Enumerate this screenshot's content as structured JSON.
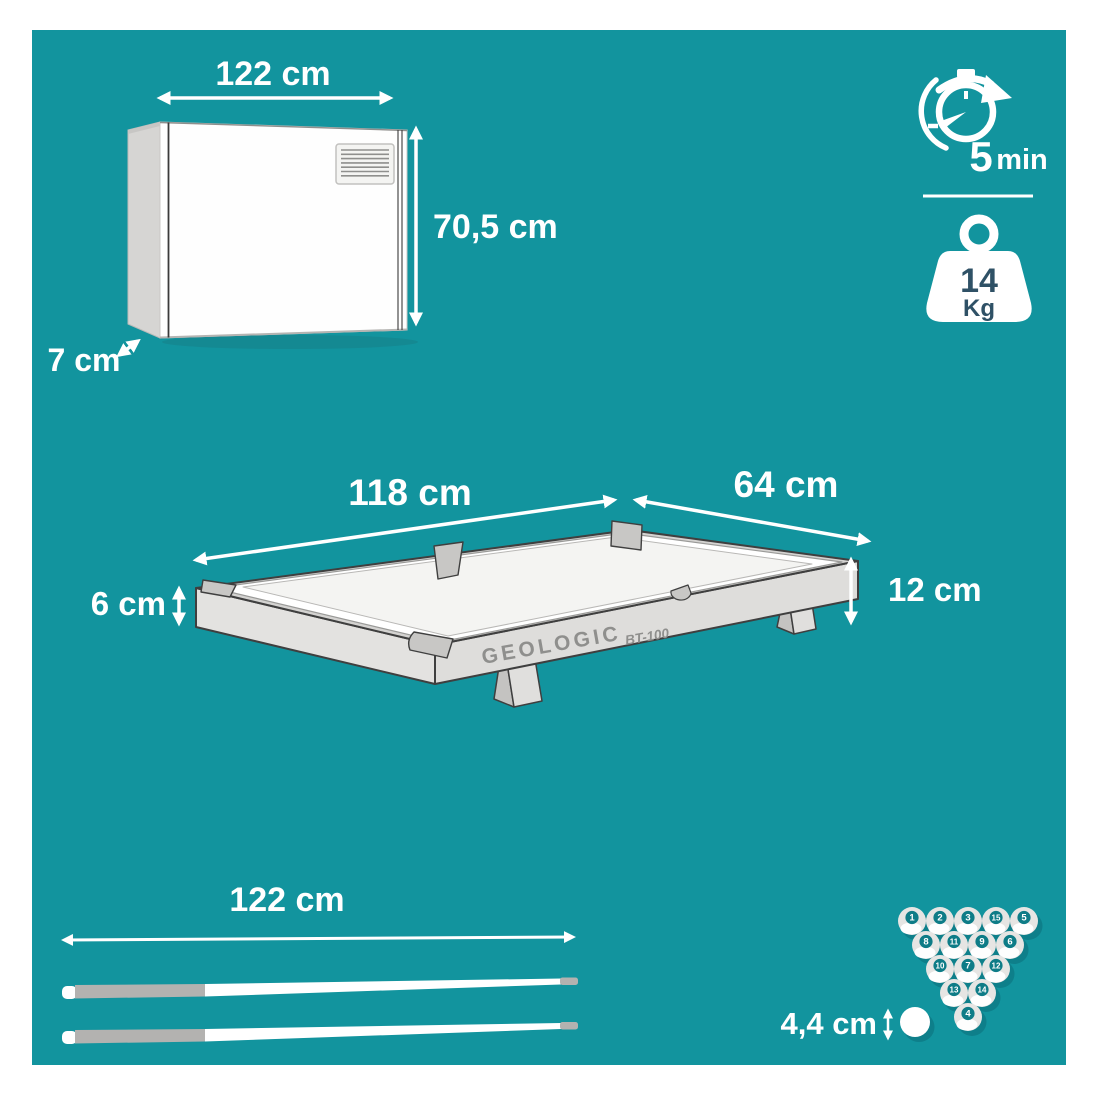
{
  "colors": {
    "panel": "#12949e",
    "ball_badge": "#0e7c87",
    "weight_text": "#2f5166",
    "label_text": "#ffffff",
    "artwork_gray": "#d6d5d3"
  },
  "packaging": {
    "width_label": "122 cm",
    "height_label": "70,5 cm",
    "depth_label": "7 cm"
  },
  "assembly": {
    "time_value": "5",
    "time_unit": "min"
  },
  "weight": {
    "value": "14",
    "unit": "Kg"
  },
  "table": {
    "brand": "GEOLOGIC",
    "model": "BT-100",
    "length_label": "118 cm",
    "width_label": "64 cm",
    "frame_height_label": "6 cm",
    "total_height_label": "12 cm"
  },
  "cues": {
    "length_label": "122 cm"
  },
  "balls": {
    "diameter_label": "4,4 cm",
    "rack": [
      "1",
      "2",
      "3",
      "15",
      "5",
      "8",
      "11",
      "9",
      "6",
      "10",
      "7",
      "12",
      "13",
      "14",
      "4"
    ]
  }
}
